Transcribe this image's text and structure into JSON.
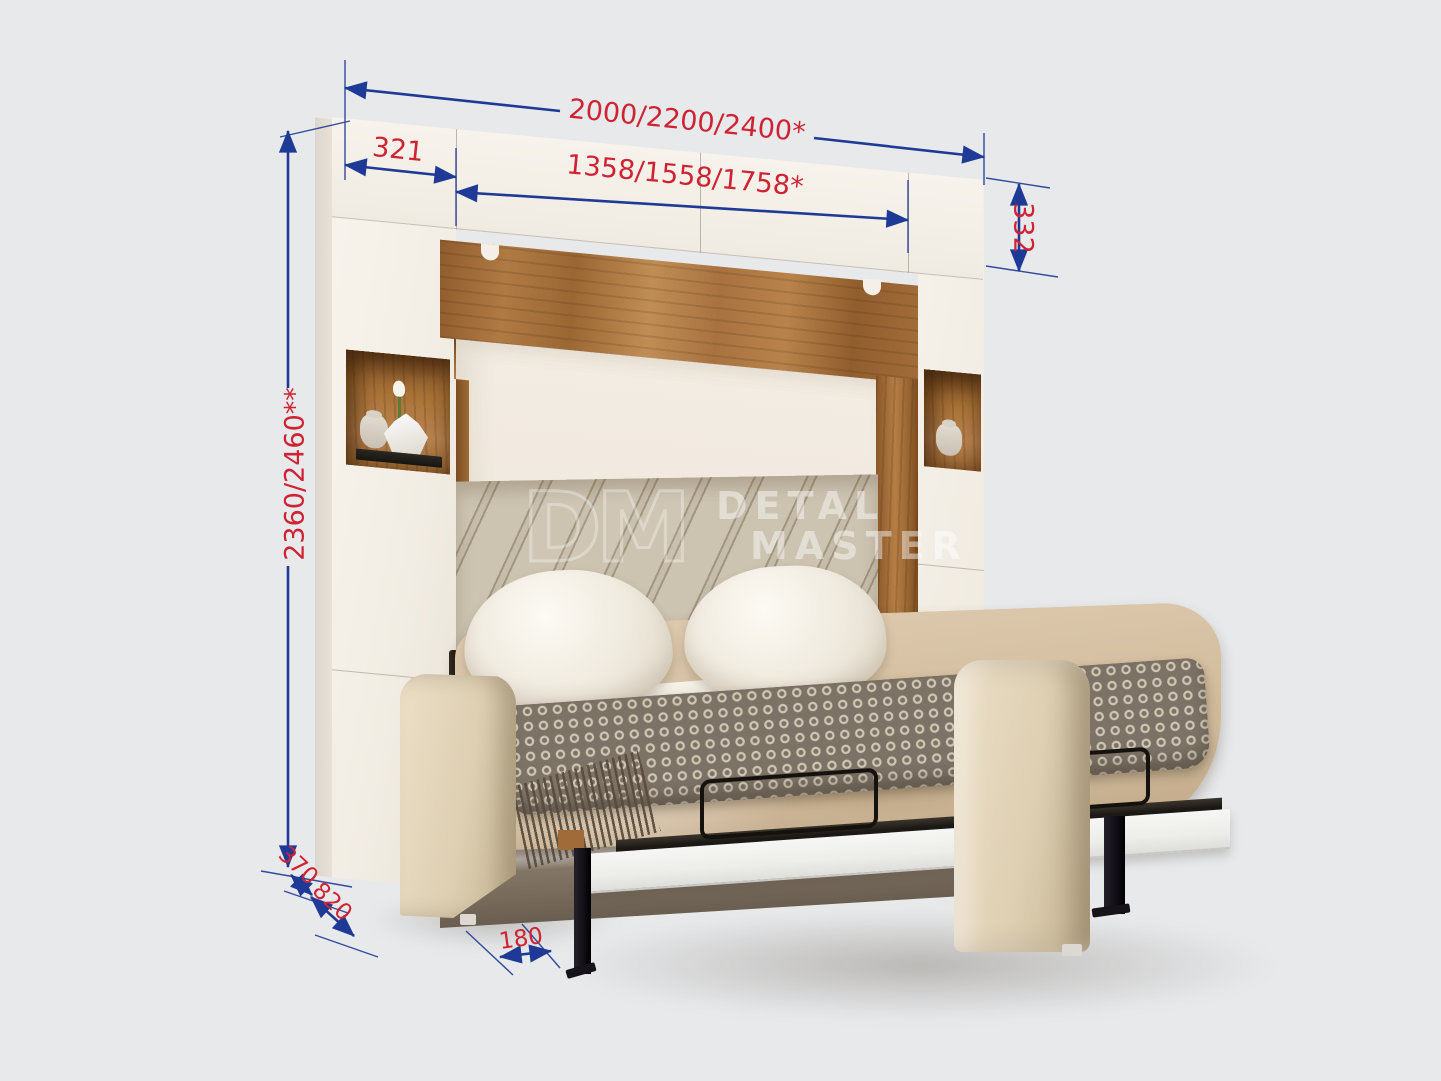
{
  "colors": {
    "background_grey": "#e8e9eb",
    "dimension_text_red": "#cf2333",
    "dimension_line_blue": "#1e3a96",
    "wood_walnut": "#ab7440",
    "cabinet_white": "#f5f1ea",
    "upholstery_beige": "#d5bfa1"
  },
  "watermark": {
    "monogram": "DM",
    "line1": "DETAL",
    "line2": "MASTER"
  },
  "dimensions": {
    "total_width": "2000/2200/2400*",
    "left_column_width": "321",
    "inner_width": "1358/1558/1758*",
    "top_cabinet_height": "332",
    "total_height": "2360/2460**",
    "top_depth": "370",
    "sofa_depth": "820",
    "leg_offset": "180"
  }
}
